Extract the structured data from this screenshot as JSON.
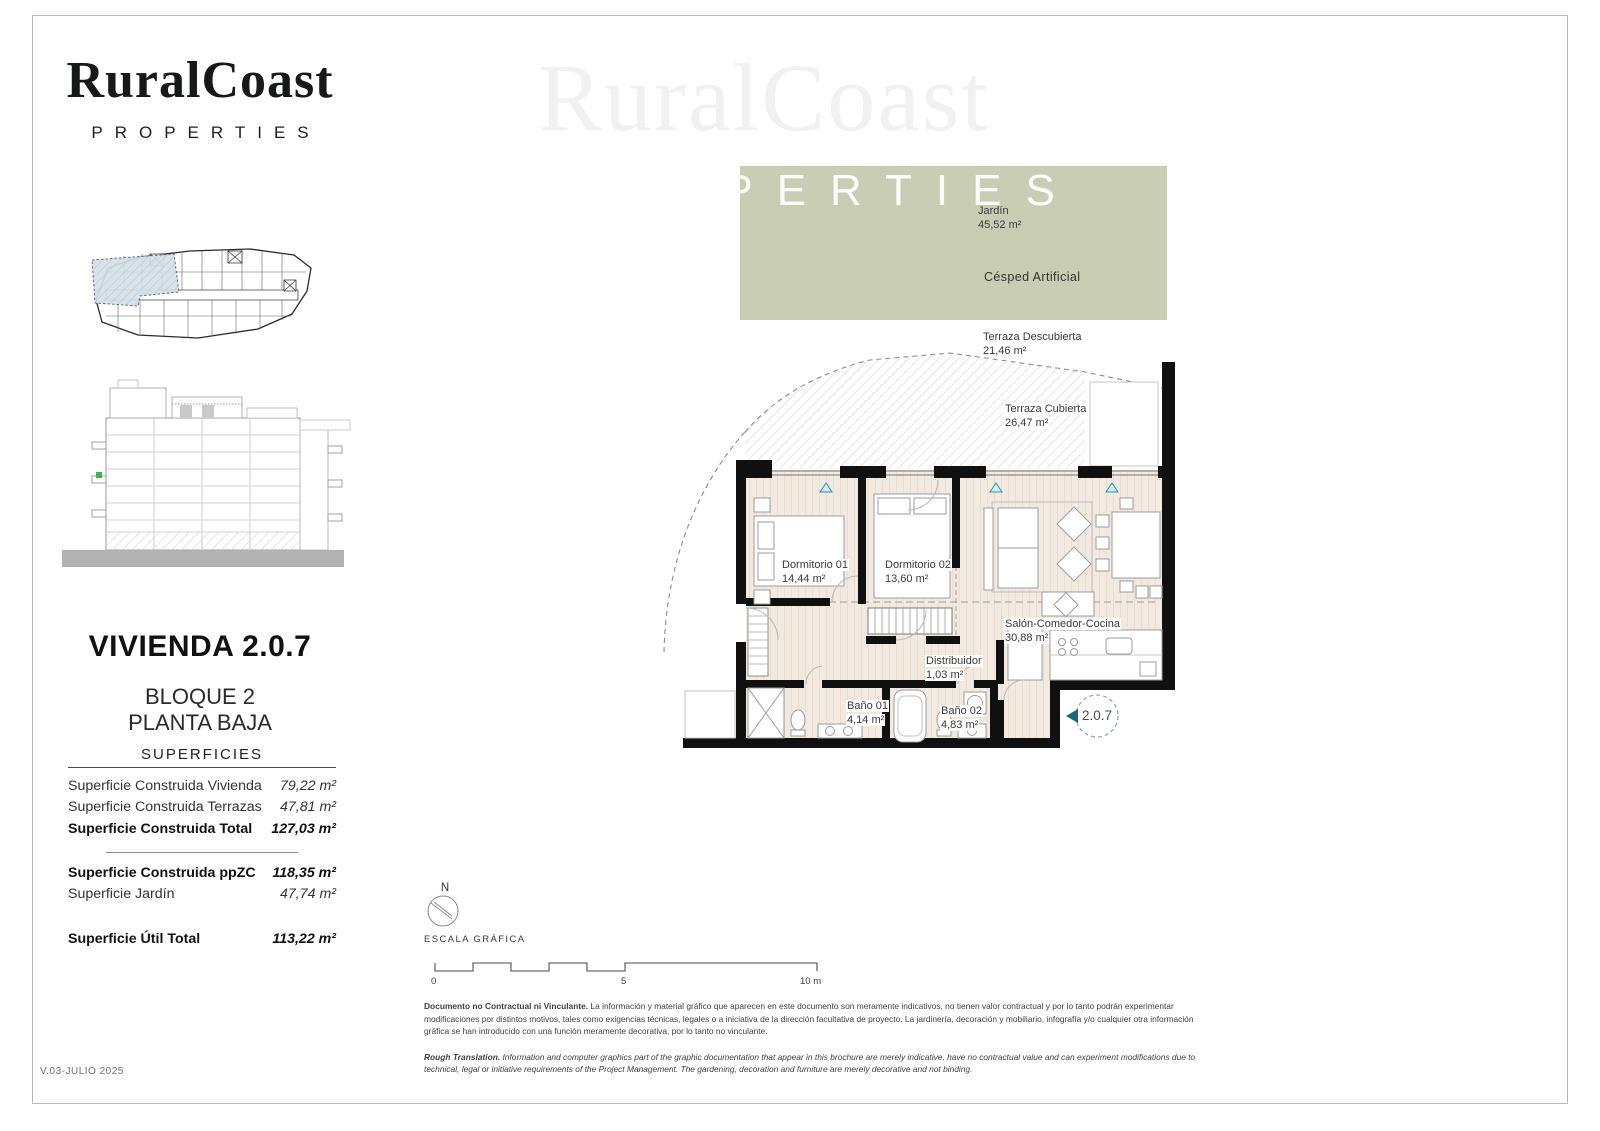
{
  "brand": {
    "name": "RuralCoast",
    "tagline": "PROPERTIES"
  },
  "watermark": {
    "name": "RuralCoast",
    "tagline": "PROPERTIES"
  },
  "unit": {
    "title": "VIVIENDA 2.0.7",
    "block": "BLOQUE 2",
    "floor": "PLANTA BAJA",
    "badge": "2.0.7"
  },
  "surfaces": {
    "title": "SUPERFICIES",
    "rows": [
      {
        "label": "Superficie Construida Vivienda",
        "value": "79,22 m²"
      },
      {
        "label": "Superficie Construida Terrazas",
        "value": "47,81 m²"
      },
      {
        "label": "Superficie Construida Total",
        "value": "127,03 m²"
      },
      {
        "label": "Superficie Construida ppZC",
        "value": "118,35 m²"
      },
      {
        "label": "Superficie Jardín",
        "value": "47,74 m²"
      },
      {
        "label": "Superficie Útil Total",
        "value": "113,22 m²"
      }
    ]
  },
  "plan": {
    "outdoor": {
      "garden_label": "Jardín",
      "garden_area": "45,52 m²",
      "garden_material": "Césped Artificial",
      "terrace_open_label": "Terraza Descubierta",
      "terrace_open_area": "21,46 m²",
      "terrace_covered_label": "Terraza Cubierta",
      "terrace_covered_area": "26,47 m²"
    },
    "rooms": [
      {
        "name": "Dormitorio 01",
        "area": "14,44 m²"
      },
      {
        "name": "Dormitorio 02",
        "area": "13,60 m²"
      },
      {
        "name": "Salón-Comedor-Cocina",
        "area": "30,88 m²"
      },
      {
        "name": "Distribuidor",
        "area": "1,03 m²"
      },
      {
        "name": "Baño 01",
        "area": "4,14 m²"
      },
      {
        "name": "Baño 02",
        "area": "4,83 m²"
      }
    ]
  },
  "compass": {
    "north": "N"
  },
  "scalebar": {
    "label": "ESCALA GRÁFICA",
    "tick0": "0",
    "tick5": "5",
    "tick10": "10 m"
  },
  "disclaimer": {
    "es_lead": "Documento no Contractual ni Vinculante.",
    "es_text": " La información y material gráfico que aparecen en este documento son meramente indicativos, no tienen valor contractual y por lo tanto podrán experimentar modificaciones por distintos motivos, tales como exigencias técnicas, legales o a iniciativa de la dirección facultativa de proyecto. La jardinería, decoración y mobiliario, infografía y/o cualquier otra información gráfica se han introducido con una función meramente decorativa, por lo tanto no vinculante.",
    "en_lead": "Rough Translation.",
    "en_text": " Information and computer graphics part of the graphic documentation that appear in this brochure are merely indicative, have no contractual value and can experiment modifications due to technical, legal or initiative requirements of the Project Management. The gardening, decoration and furniture are merely decorative and not binding."
  },
  "footer": {
    "version": "V.03-JULIO 2025"
  },
  "colors": {
    "garden": "#c9cdb3",
    "accent": "#2f93a8",
    "badge_arrow": "#16697a",
    "highlight": "#d4dfe7"
  }
}
